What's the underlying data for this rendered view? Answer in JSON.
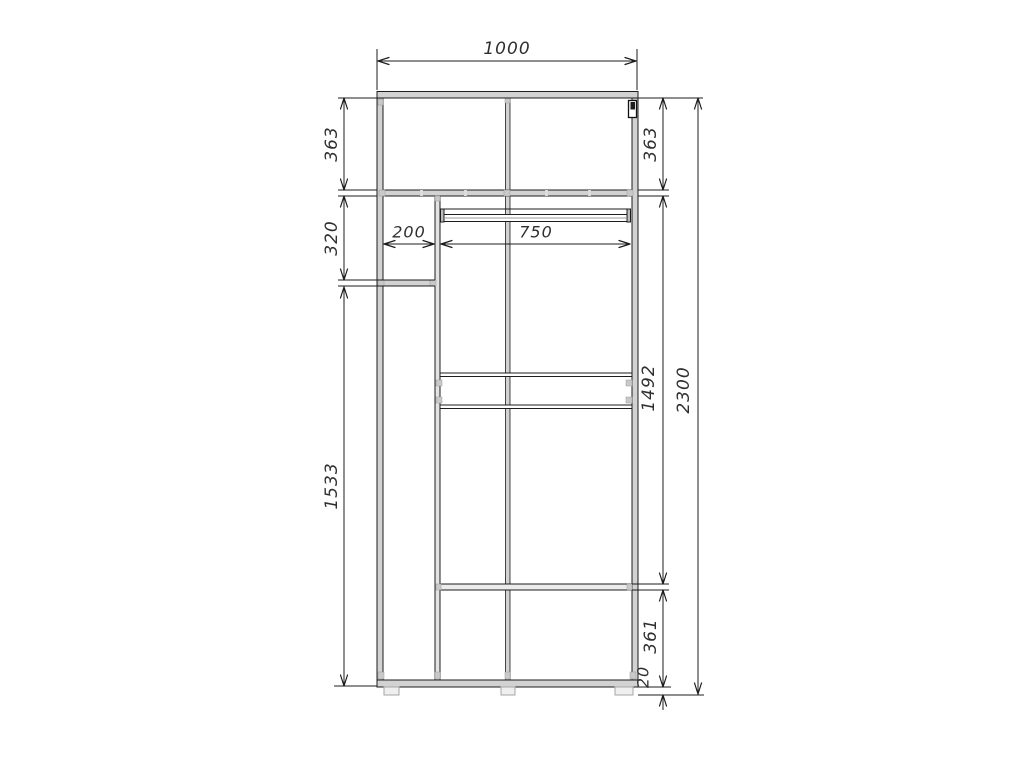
{
  "drawing_type": "wardrobe-front-elevation-technical-drawing",
  "colors": {
    "line": "#1c1c1c",
    "panel_fill": "#d2d2d2",
    "connector_fill": "#c9c9c9",
    "foot_fill": "#efefef",
    "background": "#ffffff"
  },
  "dimensions": {
    "total_width": "1000",
    "top_section_height_left": "363",
    "top_section_height_right": "363",
    "left_upper_section_height": "320",
    "left_section_width": "200",
    "main_section_width": "750",
    "left_lower_section_height": "1533",
    "main_inner_height": "1492",
    "total_height": "2300",
    "bottom_section_height": "361",
    "base_height": "20"
  }
}
